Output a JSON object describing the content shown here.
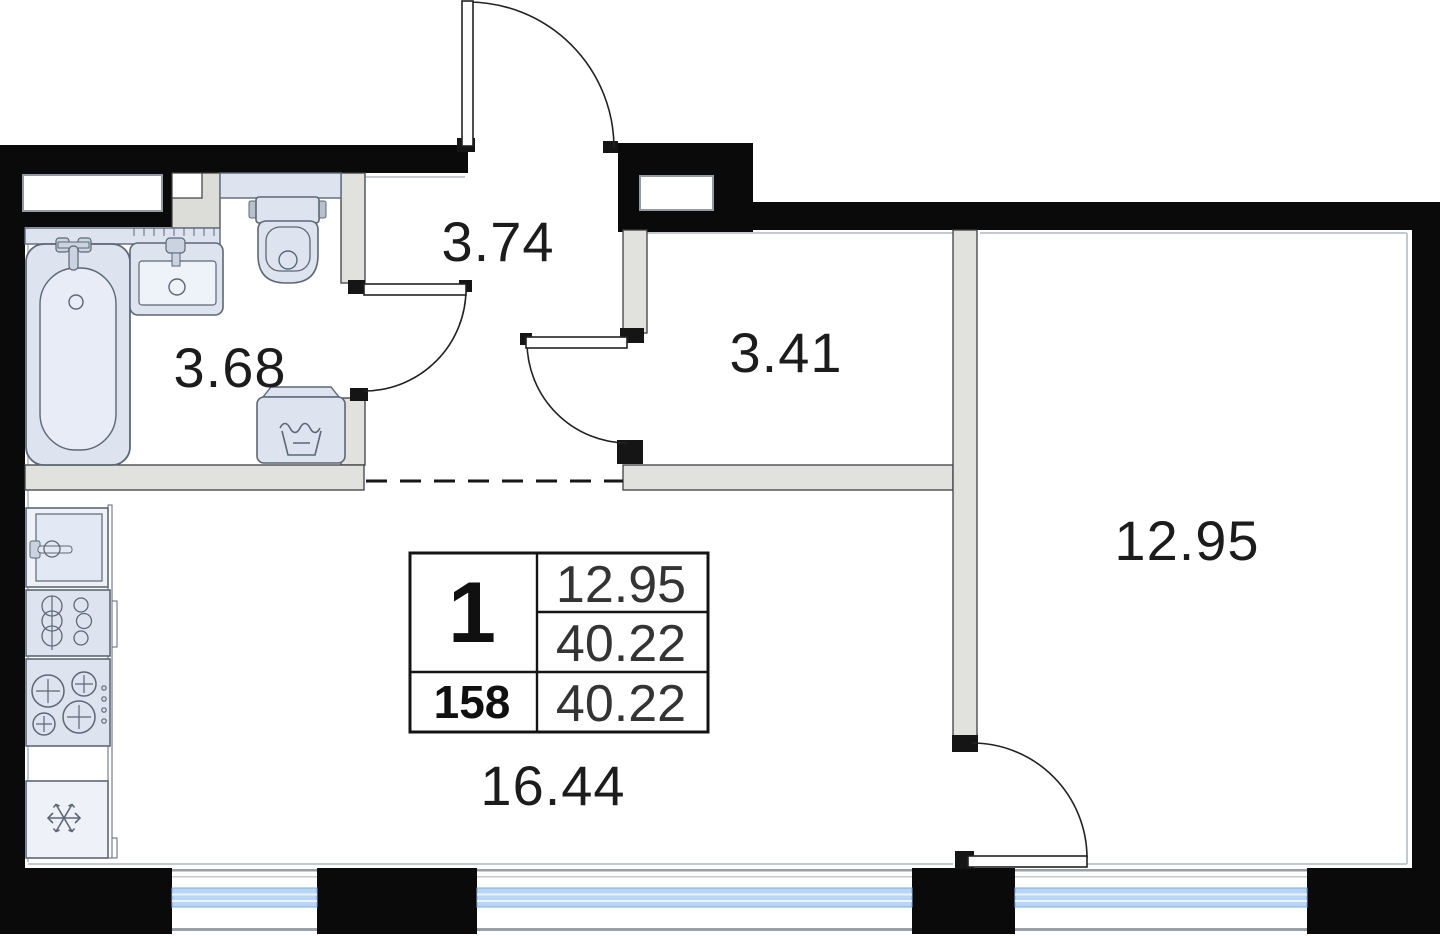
{
  "title": "Floor plan — 1-room apartment, unit 158",
  "rooms": {
    "hallway": {
      "area": "3.74"
    },
    "bathroom": {
      "area": "3.68"
    },
    "corridor": {
      "area": "3.41"
    },
    "bedroom": {
      "area": "12.95"
    },
    "kitchen_living": {
      "area": "16.44"
    }
  },
  "info_card": {
    "rooms_count": "1",
    "unit_number": "158",
    "living_area": "12.95",
    "area_mid": "40.22",
    "total_area": "40.22"
  },
  "icons": {
    "bathtub": "bathtub-top-view",
    "washbasin": "washbasin-top-view",
    "toilet": "toilet-top-view",
    "washing_machine": "washing-machine-top-view",
    "kitchen_sink": "kitchen-sink-top-view",
    "boiler_cabinet": "boiler-cabinet-top-view",
    "hob": "four-burner-hob-top-view",
    "fridge": "fridge-snowflake-top-view",
    "door": "door-swing-arc",
    "window": "window-glazing-band"
  },
  "colors": {
    "wall": "#0a0a0a",
    "partition_fill": "#e1e1de",
    "partition_stroke": "#3c4043",
    "fixture_fill": "#dde4f0",
    "fixture_stroke": "#5d6775",
    "window_glass": "#b9d6f7",
    "inner_face_line": "#c3c9d1",
    "label_text": "#1c1c1c",
    "background": "#ffffff"
  }
}
